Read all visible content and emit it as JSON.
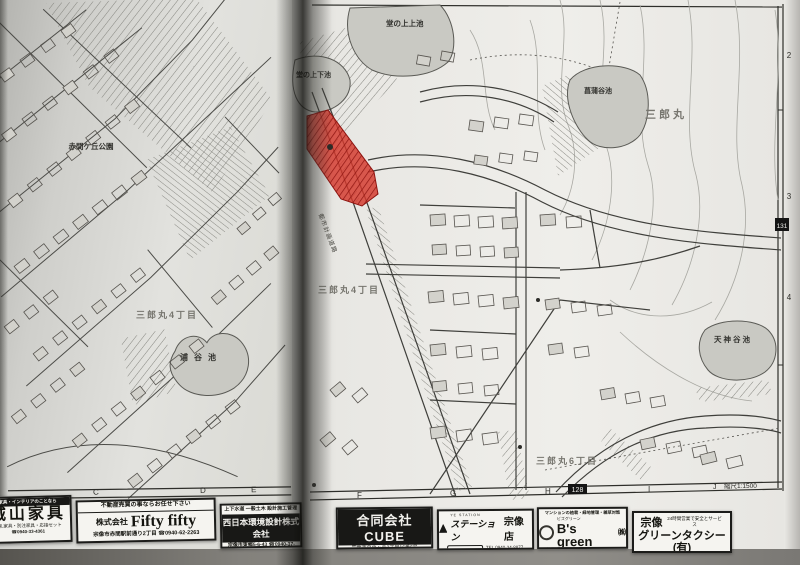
{
  "map": {
    "scale_label": "縮尺1:1500",
    "highlight_color": "#d4372b",
    "grid": {
      "bottom_letters": [
        "C",
        "D",
        "E",
        "F",
        "G",
        "H",
        "I"
      ],
      "right_numbers": [
        "2",
        "3",
        "4"
      ],
      "page_number_bottom": "128",
      "page_number_side": "131",
      "corner_letter": "J"
    },
    "labels": {
      "pond_top_upper": "堂の上上池",
      "pond_top_lower": "堂の上下池",
      "pond_shobudani": "菖蒲谷池",
      "pond_tenjindani": "天神谷池",
      "pond_uradani": "浦谷池",
      "park": "赤間ケ丘公園",
      "district_right": "三郎丸",
      "district_4_left": "三郎丸4丁目",
      "district_4_right": "三郎丸4丁目",
      "district_6": "三郎丸6丁目",
      "road": "都市計画道路"
    }
  },
  "ads": [
    {
      "header": "家具・インテリアのことなら",
      "title": "城山家具",
      "line1": "婚礼家具・別注家具・応接セット",
      "line2": "☎0940-33-4361"
    },
    {
      "header": "不動産売買の事ならお任せ下さい",
      "company": "株式会社",
      "title": "Fifty fifty",
      "line": "宗像市赤間駅前通り2丁目 ☎0940-62-2263"
    },
    {
      "header": "上下水道 一般土木 設計施工管理",
      "title": "西日本環境設計株式会社",
      "line": "宗像市東郷5-6-43 ☎0940-37-0436"
    },
    {
      "title": "合同会社CUBE",
      "line1": "宗像市自由ヶ丘3丁目16番6号",
      "line2": "☎0940-72-5226 FAX0940-72-5228"
    },
    {
      "brand_small": "YE STATION",
      "brand": "ステーション",
      "title": "宗像店",
      "badge": "アイワ企画",
      "tel": "TEL 0940-34-8877",
      "fax": "FAX 0940-34-8879"
    },
    {
      "header": "マンションの植栽・緑地管理・雑草対策",
      "title_small": "ビズグリーン",
      "title": "B's green",
      "suffix": "㈱",
      "line": "宗像市曲1592-1 TEL0940-32-8197"
    },
    {
      "region": "宗像",
      "slogan": "24時間営業で安全とサービス",
      "title": "グリーンタクシー(有)",
      "phone": "☎ 0940(33)3303"
    }
  ]
}
